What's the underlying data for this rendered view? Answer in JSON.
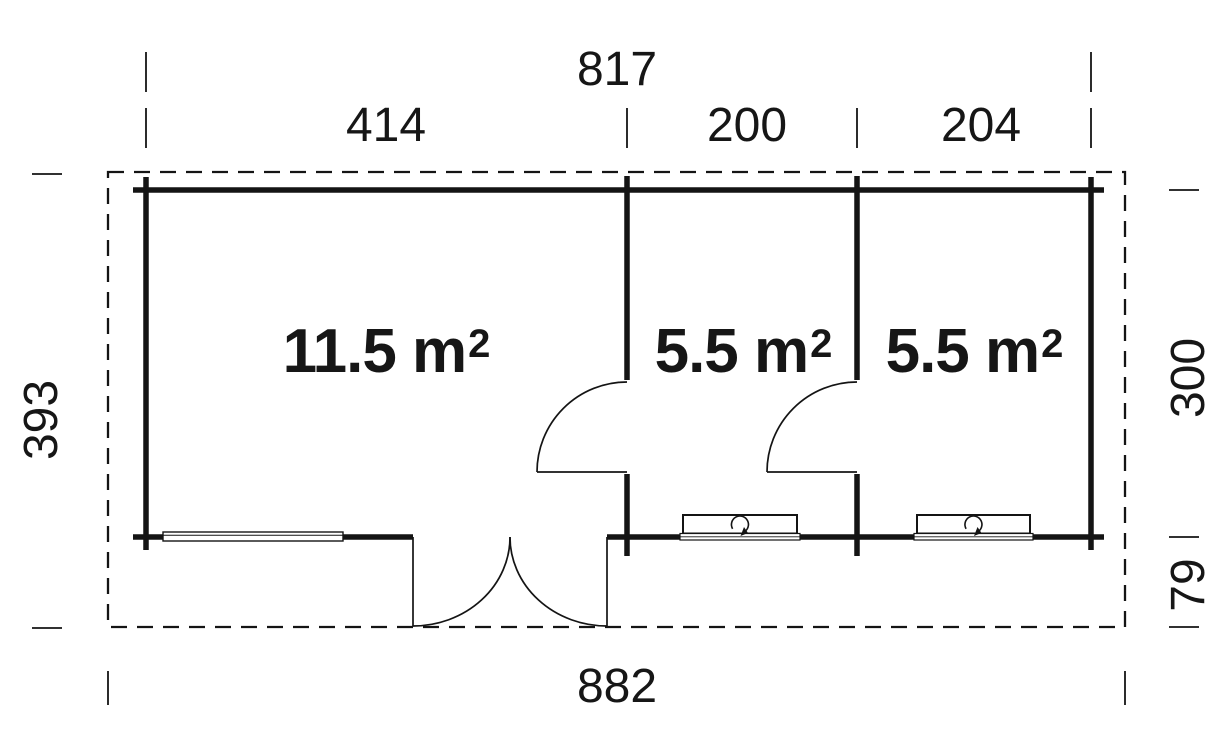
{
  "colors": {
    "line": "#141414",
    "background": "#ffffff"
  },
  "dimensions": {
    "top_total": "817",
    "top_segments": [
      "414",
      "200",
      "204"
    ],
    "outer_height": "393",
    "inner_height": "300",
    "terrace_depth": "79",
    "bottom_total": "882"
  },
  "rooms": [
    {
      "area": "11.5 m",
      "sup": "2"
    },
    {
      "area": "5.5 m",
      "sup": "2"
    },
    {
      "area": "5.5 m",
      "sup": "2"
    }
  ]
}
